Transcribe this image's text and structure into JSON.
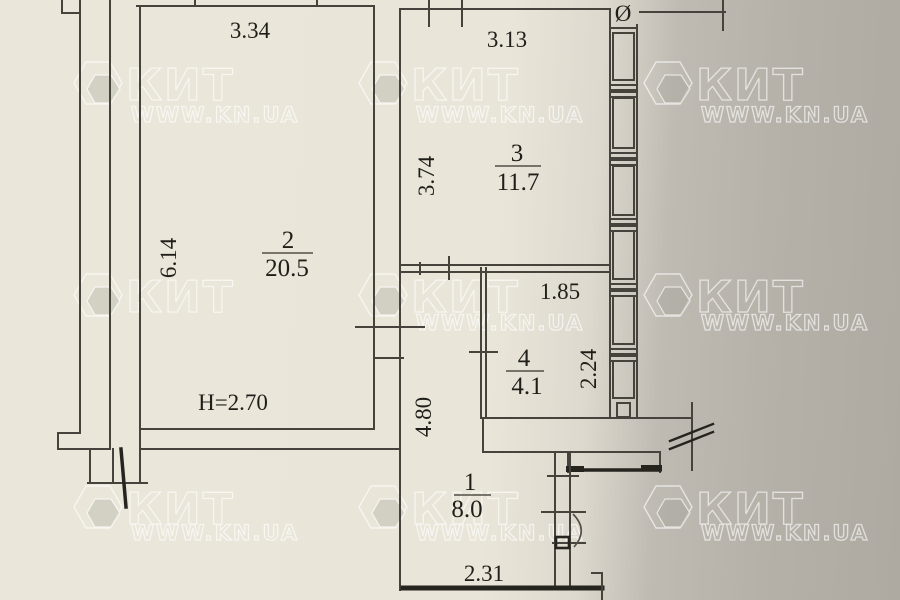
{
  "plan": {
    "room1": {
      "number": "1",
      "area": "8.0",
      "width": "2.31",
      "height": "4.80"
    },
    "room2": {
      "number": "2",
      "area": "20.5",
      "width": "3.34",
      "height": "6.14",
      "ceiling": "H=2.70"
    },
    "room3": {
      "number": "3",
      "area": "11.7",
      "width": "3.13",
      "height": "3.74"
    },
    "room4": {
      "number": "4",
      "area": "4.1",
      "width": "1.85",
      "height": "2.24"
    },
    "marks": {
      "diameter": "Ø"
    }
  },
  "watermark": {
    "brand": "КИТ",
    "site": "WWW.KN.UA"
  },
  "colors": {
    "paper": "#e9e5d9",
    "shadow": "#b3afa7",
    "ink": "#2a2822"
  }
}
